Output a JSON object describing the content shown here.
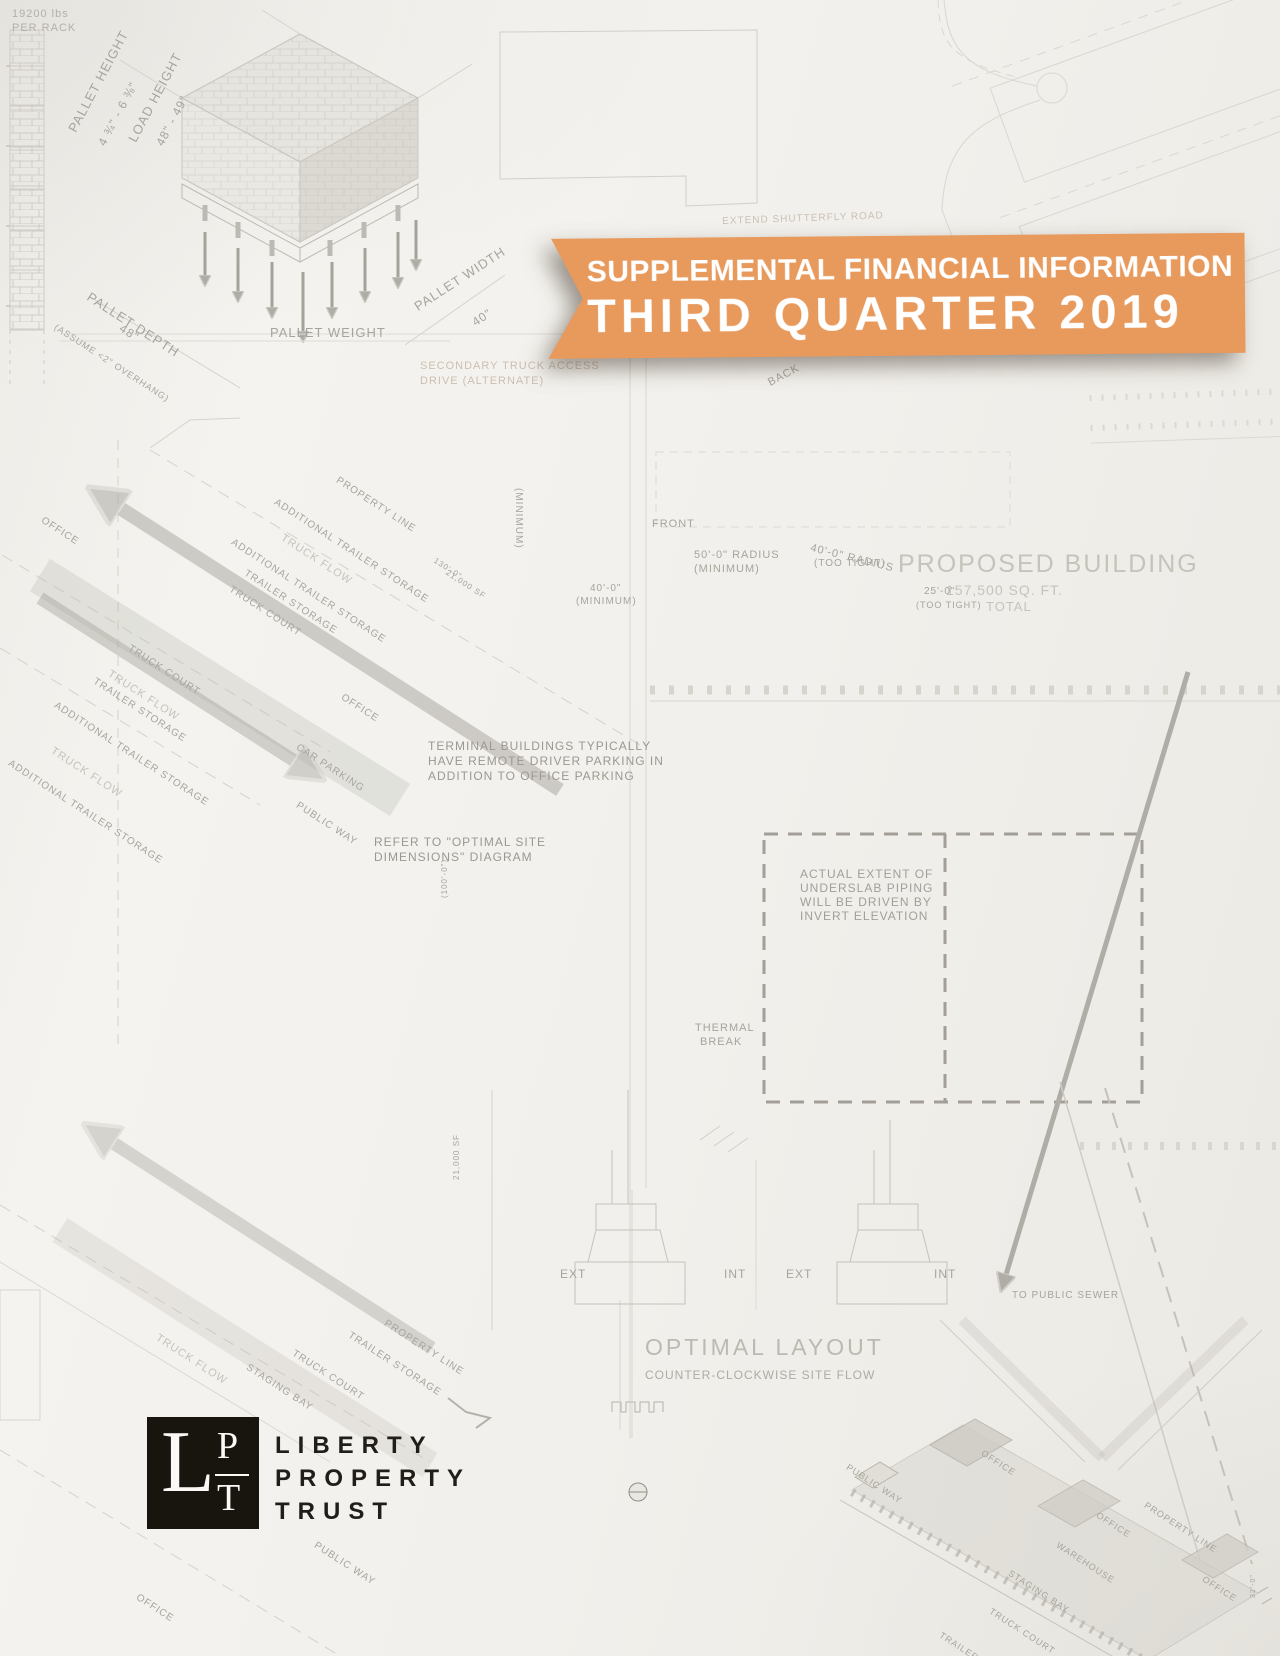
{
  "document": {
    "type": "report-cover",
    "paper_color": "#f2f0ec"
  },
  "banner": {
    "line1": "SUPPLEMENTAL FINANCIAL INFORMATION",
    "line2": "THIRD QUARTER 2019",
    "background_color": "#e8995c",
    "text_color": "#ffffff"
  },
  "logo": {
    "monogram_l": "L",
    "monogram_p": "P",
    "monogram_t": "T",
    "square_color": "#18150f",
    "company_line1": "LIBERTY",
    "company_line2": "PROPERTY",
    "company_line3": "TRUST"
  },
  "blueprint": {
    "ink_color": "#cfccc5",
    "label_color": "#a7a49c",
    "faded_label_color": "#c6c3bb",
    "labels": [
      {
        "t": "19200 lbs",
        "x": 12,
        "y": 8,
        "s": 11,
        "c": "#b3b0a8"
      },
      {
        "t": "PER RACK",
        "x": 12,
        "y": 22,
        "s": 11,
        "c": "#b3b0a8"
      },
      {
        "t": "PALLET HEIGHT",
        "x": 66,
        "y": 128,
        "r": -62,
        "s": 13
      },
      {
        "t": "4 ¾\" - 6 ⅜\"",
        "x": 96,
        "y": 142,
        "r": -62,
        "s": 12
      },
      {
        "t": "LOAD HEIGHT",
        "x": 126,
        "y": 138,
        "r": -62,
        "s": 13
      },
      {
        "t": "48\" - 49\"",
        "x": 154,
        "y": 142,
        "r": -62,
        "s": 12
      },
      {
        "t": "PALLET DEPTH",
        "x": 92,
        "y": 290,
        "r": 33,
        "s": 13
      },
      {
        "t": "48\"",
        "x": 124,
        "y": 322,
        "r": 33,
        "s": 12
      },
      {
        "t": "(ASSUME <2\" OVERHANG)",
        "x": 58,
        "y": 322,
        "r": 33,
        "s": 9
      },
      {
        "t": "PALLET WEIGHT",
        "x": 270,
        "y": 326,
        "s": 13
      },
      {
        "t": "PALLET WIDTH",
        "x": 412,
        "y": 302,
        "r": -33,
        "s": 13
      },
      {
        "t": "40\"",
        "x": 470,
        "y": 318,
        "r": -33,
        "s": 12
      },
      {
        "t": "SECONDARY TRUCK ACCESS",
        "x": 420,
        "y": 360,
        "s": 11,
        "c": "#cdbfb0"
      },
      {
        "t": "DRIVE (ALTERNATE)",
        "x": 420,
        "y": 375,
        "s": 11,
        "c": "#cdbfb0"
      },
      {
        "t": "EXTEND SHUTTERFLY ROAD",
        "x": 722,
        "y": 216,
        "s": 10,
        "r": -2,
        "c": "#c9c0b4"
      },
      {
        "t": "BACK",
        "x": 766,
        "y": 378,
        "r": -28,
        "s": 11
      },
      {
        "t": "FRONT",
        "x": 652,
        "y": 518,
        "s": 11
      },
      {
        "t": "(MINIMUM)",
        "x": 524,
        "y": 488,
        "r": 90,
        "s": 10
      },
      {
        "t": "40'-0\"",
        "x": 590,
        "y": 583,
        "s": 10
      },
      {
        "t": "(MINIMUM)",
        "x": 576,
        "y": 596,
        "s": 10
      },
      {
        "t": "50'-0\" RADIUS",
        "x": 694,
        "y": 549,
        "s": 11
      },
      {
        "t": "(MINIMUM)",
        "x": 694,
        "y": 563,
        "s": 11
      },
      {
        "t": "40'-0\" RADIUS",
        "x": 812,
        "y": 542,
        "r": 14,
        "s": 11
      },
      {
        "t": "(TOO TIGHT)",
        "x": 814,
        "y": 558,
        "s": 10
      },
      {
        "t": "PROPOSED BUILDING",
        "x": 898,
        "y": 550,
        "s": 25,
        "c": "#c6c3bb",
        "ls": 2
      },
      {
        "t": "157,500 SQ. FT.",
        "x": 946,
        "y": 582,
        "s": 14,
        "c": "#c6c3bb"
      },
      {
        "t": "TOTAL",
        "x": 986,
        "y": 600,
        "s": 13,
        "c": "#c6c3bb"
      },
      {
        "t": "25'-0\"",
        "x": 924,
        "y": 586,
        "s": 10
      },
      {
        "t": "(TOO TIGHT)",
        "x": 916,
        "y": 600,
        "s": 9
      },
      {
        "t": "OFFICE",
        "x": 45,
        "y": 515,
        "r": 33,
        "s": 10
      },
      {
        "t": "ADDITIONAL TRAILER STORAGE",
        "x": 278,
        "y": 497,
        "r": 33,
        "s": 10
      },
      {
        "t": "PROPERTY LINE",
        "x": 340,
        "y": 475,
        "r": 33,
        "s": 10
      },
      {
        "t": "TRUCK FLOW",
        "x": 285,
        "y": 532,
        "r": 33,
        "s": 11,
        "c": "#c6c3bb"
      },
      {
        "t": "ADDITIONAL TRAILER STORAGE",
        "x": 235,
        "y": 537,
        "r": 33,
        "s": 10
      },
      {
        "t": "TRAILER STORAGE",
        "x": 248,
        "y": 568,
        "r": 33,
        "s": 10
      },
      {
        "t": "TRUCK COURT",
        "x": 233,
        "y": 584,
        "r": 33,
        "s": 10
      },
      {
        "t": "TRUCK COURT",
        "x": 132,
        "y": 643,
        "r": 33,
        "s": 10
      },
      {
        "t": "TRUCK FLOW",
        "x": 112,
        "y": 668,
        "r": 33,
        "s": 11,
        "c": "#c6c3bb"
      },
      {
        "t": "TRAILER STORAGE",
        "x": 97,
        "y": 676,
        "r": 33,
        "s": 10
      },
      {
        "t": "ADDITIONAL TRAILER STORAGE",
        "x": 58,
        "y": 700,
        "r": 33,
        "s": 10
      },
      {
        "t": "TRUCK FLOW",
        "x": 55,
        "y": 745,
        "r": 33,
        "s": 11,
        "c": "#c6c3bb"
      },
      {
        "t": "ADDITIONAL TRAILER STORAGE",
        "x": 12,
        "y": 758,
        "r": 33,
        "s": 10
      },
      {
        "t": "OFFICE",
        "x": 345,
        "y": 692,
        "r": 33,
        "s": 10
      },
      {
        "t": "CAR PARKING",
        "x": 300,
        "y": 742,
        "r": 33,
        "s": 10
      },
      {
        "t": "PUBLIC WAY",
        "x": 300,
        "y": 800,
        "r": 33,
        "s": 10
      },
      {
        "t": "130'-0\"",
        "x": 437,
        "y": 556,
        "r": 33,
        "s": 8
      },
      {
        "t": "21,000 SF",
        "x": 449,
        "y": 568,
        "r": 33,
        "s": 8
      },
      {
        "t": "(100'-0\")",
        "x": 440,
        "y": 898,
        "r": -90,
        "s": 8
      },
      {
        "t": "21,000 SF",
        "x": 452,
        "y": 1180,
        "r": -90,
        "s": 8
      },
      {
        "t": "TERMINAL BUILDINGS TYPICALLY",
        "x": 428,
        "y": 740,
        "s": 12,
        "c": "#9c9890"
      },
      {
        "t": "HAVE REMOTE DRIVER PARKING IN",
        "x": 428,
        "y": 755,
        "s": 12,
        "c": "#9c9890"
      },
      {
        "t": "ADDITION TO OFFICE PARKING",
        "x": 428,
        "y": 770,
        "s": 12,
        "c": "#9c9890"
      },
      {
        "t": "REFER TO \"OPTIMAL SITE",
        "x": 374,
        "y": 836,
        "s": 12,
        "c": "#9c9890"
      },
      {
        "t": "DIMENSIONS\" DIAGRAM",
        "x": 374,
        "y": 851,
        "s": 12,
        "c": "#9c9890"
      },
      {
        "t": "ACTUAL EXTENT OF",
        "x": 800,
        "y": 868,
        "s": 12,
        "c": "#a29f97"
      },
      {
        "t": "UNDERSLAB PIPING",
        "x": 800,
        "y": 882,
        "s": 12,
        "c": "#a29f97"
      },
      {
        "t": "WILL BE DRIVEN BY",
        "x": 800,
        "y": 896,
        "s": 12,
        "c": "#a29f97"
      },
      {
        "t": "INVERT ELEVATION",
        "x": 800,
        "y": 910,
        "s": 12,
        "c": "#a29f97"
      },
      {
        "t": "THERMAL",
        "x": 695,
        "y": 1022,
        "s": 11
      },
      {
        "t": "BREAK",
        "x": 700,
        "y": 1036,
        "s": 11
      },
      {
        "t": "EXT",
        "x": 560,
        "y": 1268,
        "s": 12
      },
      {
        "t": "INT",
        "x": 724,
        "y": 1268,
        "s": 12
      },
      {
        "t": "EXT",
        "x": 786,
        "y": 1268,
        "s": 12
      },
      {
        "t": "INT",
        "x": 934,
        "y": 1268,
        "s": 12
      },
      {
        "t": "TO PUBLIC SEWER",
        "x": 1012,
        "y": 1290,
        "s": 10
      },
      {
        "t": "OPTIMAL LAYOUT",
        "x": 645,
        "y": 1334,
        "s": 23,
        "c": "#bcb9b1",
        "ls": 3
      },
      {
        "t": "COUNTER-CLOCKWISE SITE FLOW",
        "x": 645,
        "y": 1369,
        "s": 12,
        "c": "#aeaba3"
      },
      {
        "t": "STAGING BAY",
        "x": 250,
        "y": 1362,
        "r": 33,
        "s": 10
      },
      {
        "t": "TRUCK COURT",
        "x": 296,
        "y": 1348,
        "r": 33,
        "s": 10
      },
      {
        "t": "TRUCK FLOW",
        "x": 160,
        "y": 1332,
        "r": 33,
        "s": 11,
        "c": "#c6c3bb"
      },
      {
        "t": "TRAILER STORAGE",
        "x": 352,
        "y": 1330,
        "r": 33,
        "s": 10
      },
      {
        "t": "PROPERTY LINE",
        "x": 388,
        "y": 1318,
        "r": 33,
        "s": 10
      },
      {
        "t": "PUBLIC WAY",
        "x": 318,
        "y": 1540,
        "r": 33,
        "s": 10
      },
      {
        "t": "OFFICE",
        "x": 140,
        "y": 1592,
        "r": 33,
        "s": 10
      },
      {
        "t": "PUBLIC WAY",
        "x": 850,
        "y": 1462,
        "r": 33,
        "s": 9
      },
      {
        "t": "OFFICE",
        "x": 985,
        "y": 1448,
        "r": 33,
        "s": 9
      },
      {
        "t": "OFFICE",
        "x": 1100,
        "y": 1510,
        "r": 33,
        "s": 9
      },
      {
        "t": "WAREHOUSE",
        "x": 1060,
        "y": 1540,
        "r": 33,
        "s": 9
      },
      {
        "t": "PROPERTY LINE",
        "x": 1148,
        "y": 1500,
        "r": 33,
        "s": 9
      },
      {
        "t": "STAGING BAY",
        "x": 1012,
        "y": 1568,
        "r": 33,
        "s": 9
      },
      {
        "t": "TRUCK COURT",
        "x": 993,
        "y": 1606,
        "r": 33,
        "s": 9
      },
      {
        "t": "TRAILER STORAGE",
        "x": 943,
        "y": 1630,
        "r": 33,
        "s": 9
      },
      {
        "t": "OFFICE",
        "x": 1206,
        "y": 1574,
        "r": 33,
        "s": 9
      },
      {
        "t": "32'-0\"",
        "x": 1250,
        "y": 1598,
        "r": -90,
        "s": 7
      }
    ]
  }
}
